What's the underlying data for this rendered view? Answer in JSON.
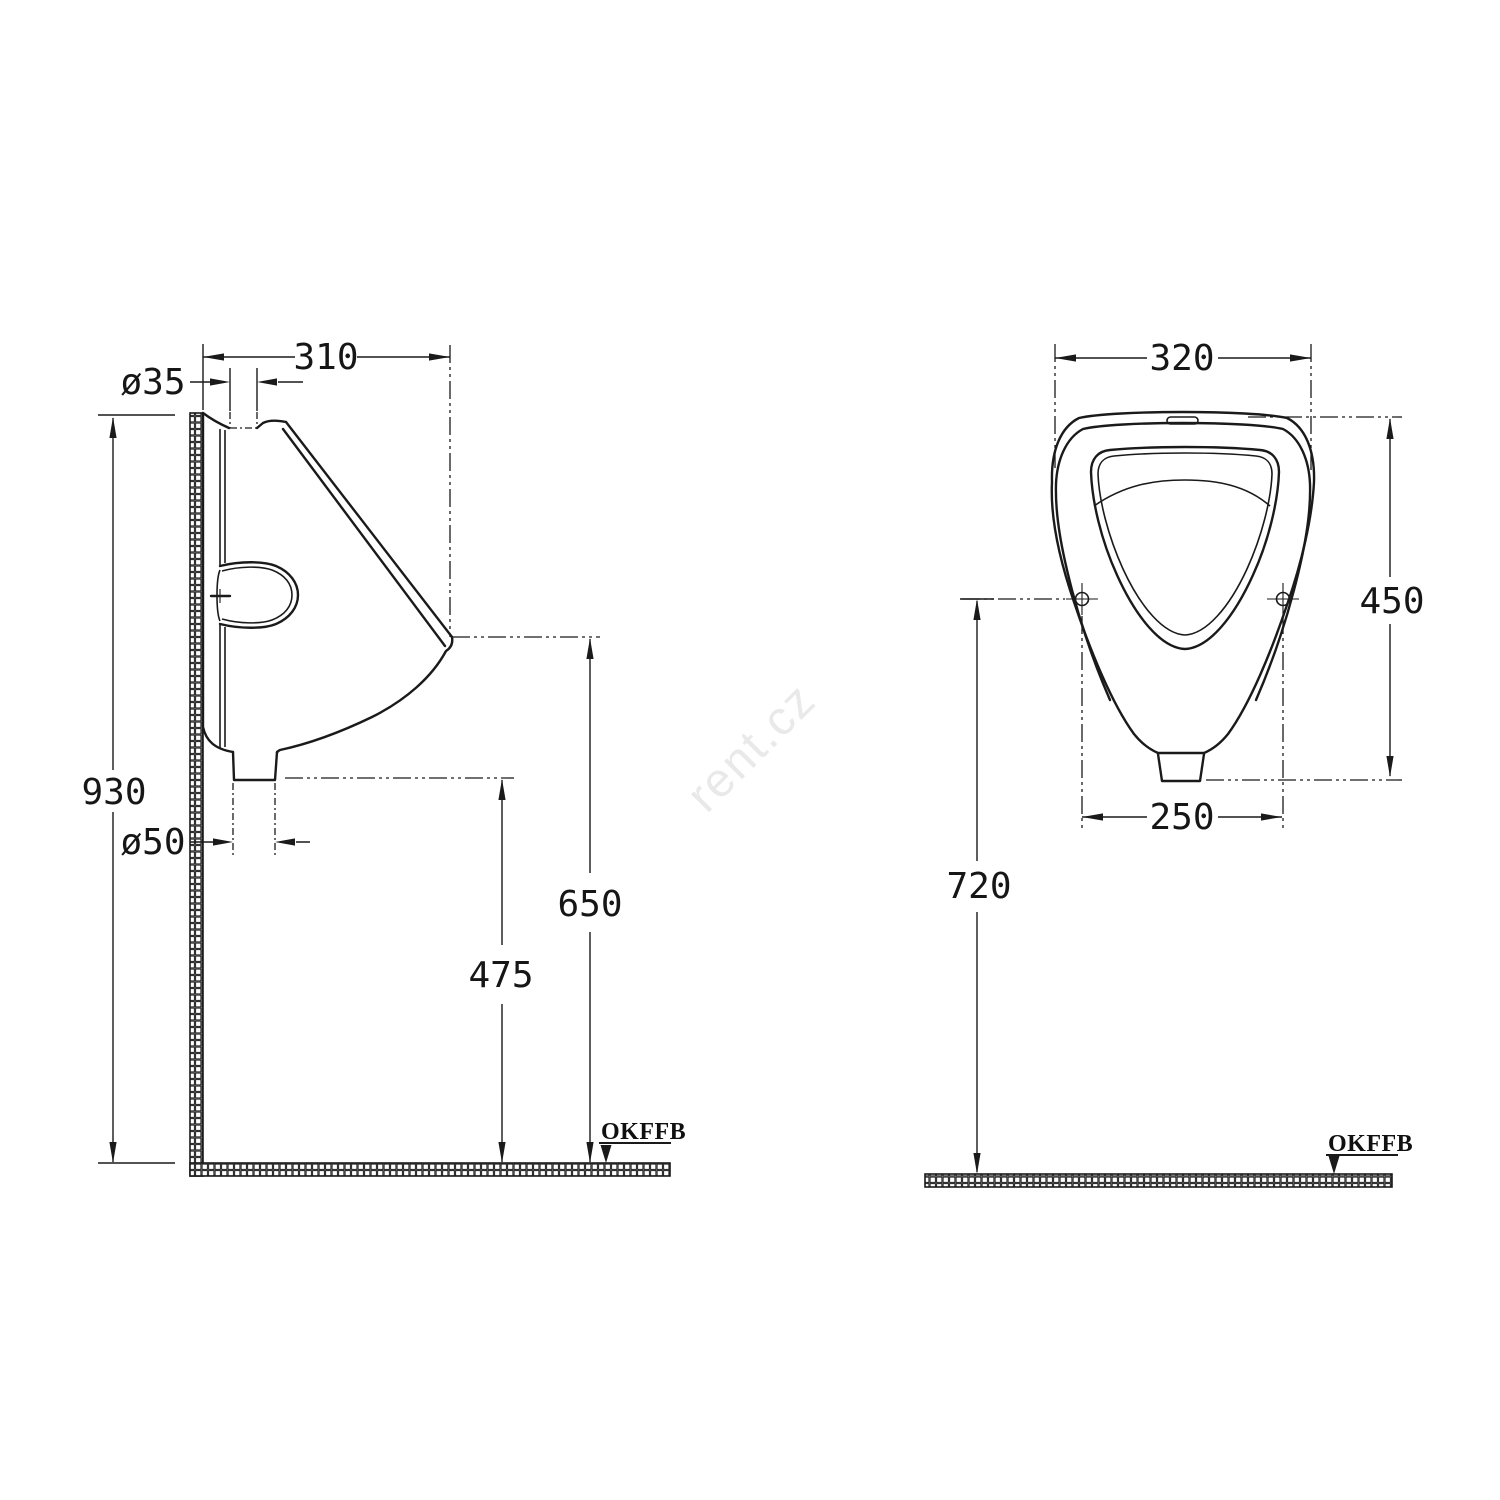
{
  "watermark": "rent.cz",
  "side_view": {
    "width_310": "310",
    "inlet_diameter": "ø35",
    "overall_height_930": "930",
    "outlet_diameter": "ø50",
    "outlet_height_475": "475",
    "rim_height_650": "650",
    "floor_datum_label": "OKFFB"
  },
  "front_view": {
    "width_320": "320",
    "height_450": "450",
    "bolt_spacing_250": "250",
    "mounting_height_720": "720",
    "floor_datum_label": "OKFFB"
  },
  "colors": {
    "line": "#1a1a1a",
    "watermark": "#e9e9e9",
    "background": "#ffffff"
  }
}
